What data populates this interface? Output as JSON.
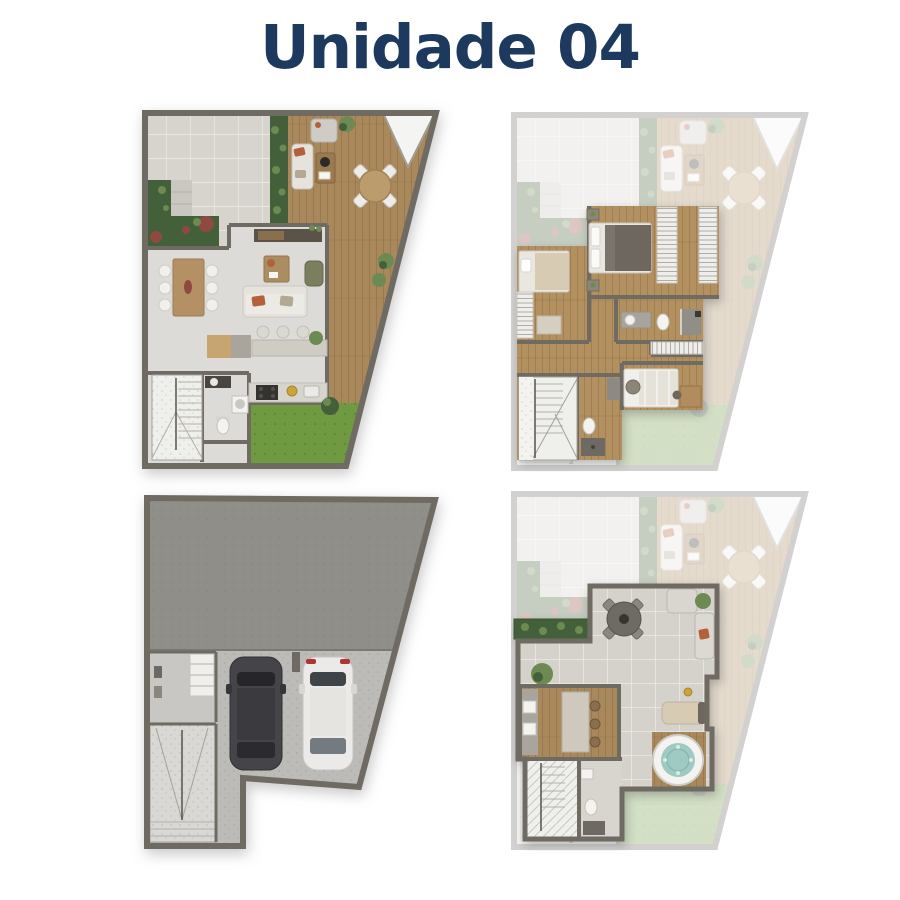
{
  "page": {
    "title": "Unidade 04"
  },
  "colors": {
    "page_bg": "#ffffff",
    "title_navy": "#1d3a5e",
    "wall_dark": "#6f6b63",
    "wood_deck": "#a9895c",
    "wood_floor_upper": "#b2905f",
    "interior_floor": "#dcdbd7",
    "stone_patio": "#d7d4ce",
    "stone_terrace": "#d5d2cb",
    "grass_green": "#6f9a42",
    "plant_green": "#44603a",
    "plant_light": "#6d8a52",
    "plant_red": "#8e4a40",
    "slab_gray": "#8f8e89",
    "concrete_floor": "#bcbbb7",
    "car_dark_body": "#454549",
    "car_white_body": "#eceae8",
    "white_fixture": "#f4f3f0",
    "sofa_fabric": "#e6e3dd",
    "cushion_rust": "#b2613a",
    "armchair_olive": "#7c7f5e",
    "counter_stone": "#cfccc4",
    "cabinet_gray": "#a9a59d",
    "cabinet_wood": "#c7a571",
    "bed_blanket_dark": "#6e6760",
    "bed_beige": "#d8cbb4",
    "tub_water": "#9ecac3",
    "stair_light": "#efefec",
    "table_dark": "#6e6b65"
  }
}
